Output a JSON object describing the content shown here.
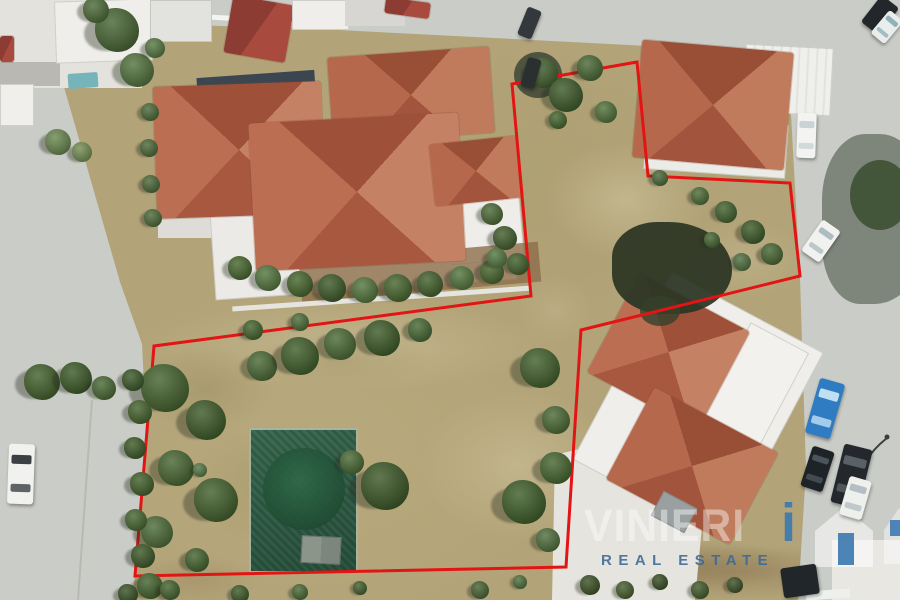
{
  "watermark": {
    "wordmark": "VINIERI",
    "accent_letter": "i",
    "subtitle": "REAL ESTATE",
    "accent_color": "#3d7ab0",
    "subtitle_color": "rgba(58,105,150,0.88)"
  },
  "boundary": {
    "color": "#e31414",
    "width": 3,
    "points": "512,84 637,62 648,176 790,183 800,276 581,330 566,567 135,576 154,346 531,296"
  },
  "scene": {
    "patches": [
      [
        545,
        140,
        160,
        120,
        "#cfc29c",
        0.6
      ],
      [
        630,
        80,
        150,
        100,
        "#9a9160",
        0.5
      ],
      [
        680,
        220,
        130,
        80,
        "#c6b992",
        0.5
      ],
      [
        510,
        60,
        90,
        70,
        "#a99c6e",
        0.5
      ],
      [
        150,
        300,
        400,
        90,
        "#cfc29d",
        0.5
      ],
      [
        420,
        390,
        200,
        150,
        "#cbbe97",
        0.6
      ],
      [
        190,
        420,
        170,
        130,
        "#99905f",
        0.4
      ],
      [
        140,
        345,
        130,
        90,
        "#8f8758",
        0.35
      ],
      [
        540,
        545,
        380,
        55,
        "#97815c",
        0.65
      ],
      [
        130,
        555,
        130,
        50,
        "#a08a62",
        0.5
      ],
      [
        515,
        275,
        80,
        70,
        "#c2b58e",
        0.5
      ],
      [
        250,
        330,
        180,
        60,
        "#a39567",
        0.45
      ],
      [
        600,
        540,
        200,
        50,
        "#8a7650",
        0.5
      ]
    ],
    "trees": [
      [
        117,
        30,
        22,
        "#4a6836"
      ],
      [
        137,
        70,
        17,
        "#557540"
      ],
      [
        96,
        10,
        13,
        "#4f6d3a"
      ],
      [
        155,
        48,
        10,
        "#5a7a44"
      ],
      [
        58,
        142,
        13,
        "#6b8a50"
      ],
      [
        82,
        152,
        10,
        "#768f55"
      ],
      [
        150,
        112,
        9,
        "#4e6b3a"
      ],
      [
        149,
        148,
        9,
        "#4e6b3a"
      ],
      [
        151,
        184,
        9,
        "#4e6b3a"
      ],
      [
        153,
        218,
        9,
        "#4e6b3a"
      ],
      [
        240,
        268,
        12,
        "#49682f"
      ],
      [
        268,
        278,
        13,
        "#567840"
      ],
      [
        300,
        284,
        13,
        "#49682f"
      ],
      [
        332,
        288,
        14,
        "#3f5c2a"
      ],
      [
        365,
        290,
        13,
        "#567840"
      ],
      [
        398,
        288,
        14,
        "#49682f"
      ],
      [
        430,
        284,
        13,
        "#44622e"
      ],
      [
        462,
        278,
        12,
        "#567840"
      ],
      [
        492,
        272,
        12,
        "#49682f"
      ],
      [
        518,
        264,
        11,
        "#44622e"
      ],
      [
        492,
        214,
        11,
        "#4d6c38"
      ],
      [
        505,
        238,
        12,
        "#43602e"
      ],
      [
        497,
        258,
        10,
        "#567943"
      ],
      [
        543,
        73,
        15,
        "#456331"
      ],
      [
        566,
        95,
        17,
        "#3f5c2c"
      ],
      [
        590,
        68,
        13,
        "#4c6b36"
      ],
      [
        606,
        112,
        11,
        "#53743c"
      ],
      [
        558,
        120,
        9,
        "#47662f"
      ],
      [
        700,
        196,
        9,
        "#4f6e38"
      ],
      [
        726,
        212,
        11,
        "#45642f"
      ],
      [
        753,
        232,
        12,
        "#3f5c2a"
      ],
      [
        772,
        254,
        11,
        "#4a6834"
      ],
      [
        742,
        262,
        9,
        "#527241"
      ],
      [
        712,
        240,
        8,
        "#486733"
      ],
      [
        660,
        178,
        8,
        "#4c6a37"
      ],
      [
        165,
        388,
        24,
        "#47652f"
      ],
      [
        206,
        420,
        20,
        "#3f5c2a"
      ],
      [
        176,
        468,
        18,
        "#4a6834"
      ],
      [
        216,
        500,
        22,
        "#44622e"
      ],
      [
        157,
        532,
        16,
        "#4f6e3a"
      ],
      [
        197,
        560,
        12,
        "#46652f"
      ],
      [
        262,
        366,
        15,
        "#4c6b36"
      ],
      [
        300,
        356,
        19,
        "#42602c"
      ],
      [
        340,
        344,
        16,
        "#4d6c37"
      ],
      [
        382,
        338,
        18,
        "#3f5c2a"
      ],
      [
        420,
        330,
        12,
        "#4a6a35"
      ],
      [
        385,
        486,
        24,
        "#3e5a29"
      ],
      [
        352,
        462,
        12,
        "#4c6b36"
      ],
      [
        540,
        368,
        20,
        "#44622e"
      ],
      [
        556,
        420,
        14,
        "#4d6c37"
      ],
      [
        524,
        502,
        22,
        "#40602b"
      ],
      [
        556,
        468,
        16,
        "#486831"
      ],
      [
        548,
        540,
        12,
        "#52713f"
      ],
      [
        200,
        470,
        7,
        "#567a45"
      ],
      [
        300,
        322,
        9,
        "#4f6e3a"
      ],
      [
        253,
        330,
        10,
        "#46652f"
      ],
      [
        133,
        380,
        11,
        "#3d5a2a"
      ],
      [
        140,
        412,
        12,
        "#47652f"
      ],
      [
        135,
        448,
        11,
        "#3f5c2a"
      ],
      [
        142,
        484,
        12,
        "#44622e"
      ],
      [
        136,
        520,
        11,
        "#4a6834"
      ],
      [
        143,
        556,
        12,
        "#3e5a29"
      ],
      [
        150,
        586,
        13,
        "#46652f"
      ],
      [
        128,
        594,
        10,
        "#3a5527"
      ],
      [
        42,
        382,
        18,
        "#45632e"
      ],
      [
        76,
        378,
        16,
        "#3e5c2a"
      ],
      [
        104,
        388,
        12,
        "#4c6b36"
      ],
      [
        590,
        585,
        10,
        "#3f5429"
      ],
      [
        625,
        590,
        9,
        "#47602f"
      ],
      [
        660,
        582,
        8,
        "#3a5025"
      ],
      [
        700,
        590,
        9,
        "#445c2c"
      ],
      [
        735,
        585,
        8,
        "#3e5429"
      ],
      [
        480,
        590,
        9,
        "#4a6534"
      ],
      [
        520,
        582,
        7,
        "#52713f"
      ],
      [
        300,
        592,
        8,
        "#4c6b36"
      ],
      [
        360,
        588,
        7,
        "#44622e"
      ],
      [
        240,
        594,
        9,
        "#3f5c2a"
      ],
      [
        170,
        590,
        10,
        "#46652f"
      ]
    ],
    "cars": [
      [
        522,
        8,
        15,
        30,
        22,
        "#33383c",
        ""
      ],
      [
        524,
        58,
        14,
        30,
        16,
        "#2a3030",
        ""
      ],
      [
        869,
        -2,
        22,
        34,
        38,
        "#23272b",
        ""
      ],
      [
        878,
        12,
        18,
        30,
        40,
        "#e9edec",
        "#8fb2b8"
      ],
      [
        797,
        113,
        19,
        45,
        2,
        "#f3f4f1",
        "#c9d2d4"
      ],
      [
        810,
        222,
        22,
        38,
        35,
        "#f1f2ef",
        "#aebcc2"
      ],
      [
        812,
        380,
        26,
        57,
        16,
        "#2f7cc2",
        "#bfe0f2"
      ],
      [
        806,
        448,
        23,
        42,
        18,
        "#1e2327",
        "#4a545a"
      ],
      [
        837,
        446,
        29,
        60,
        14,
        "#24282c",
        "#5a6166"
      ],
      [
        844,
        478,
        23,
        40,
        16,
        "#eef0ec",
        "#b3bfc4"
      ],
      [
        8,
        444,
        26,
        60,
        2,
        "#f1f2ef",
        "#3a4043"
      ],
      [
        782,
        566,
        36,
        30,
        -8,
        "#20262a",
        ""
      ]
    ]
  }
}
